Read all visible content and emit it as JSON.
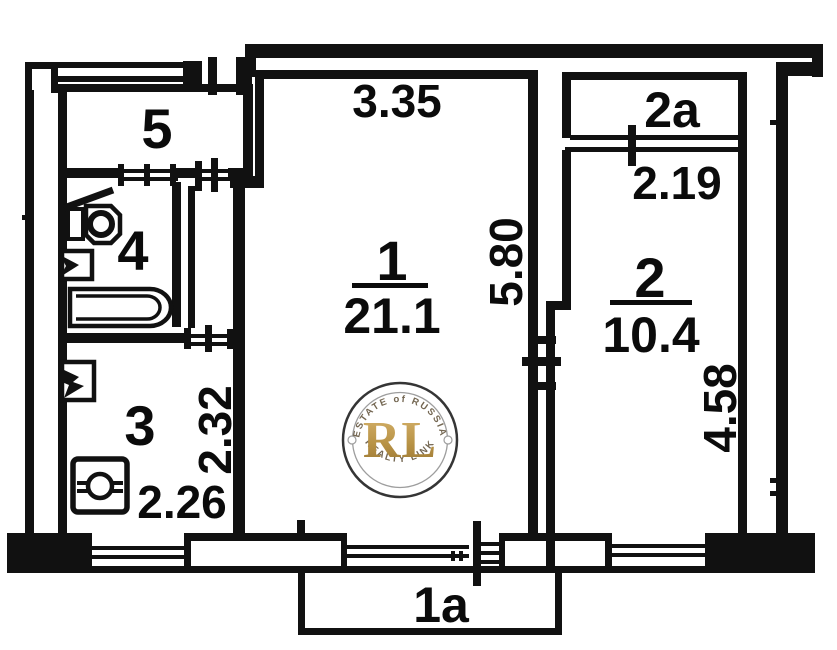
{
  "plan": {
    "title": "apartment-floor-plan",
    "rooms": [
      {
        "id": "room-1",
        "number": "1",
        "area": "21.1"
      },
      {
        "id": "room-2",
        "number": "2",
        "area": "10.4"
      },
      {
        "id": "room-3",
        "number": "3"
      },
      {
        "id": "room-4",
        "number": "4"
      },
      {
        "id": "room-5",
        "number": "5"
      },
      {
        "id": "balcony-2a",
        "number": "2a"
      },
      {
        "id": "balcony-1a",
        "number": "1a"
      }
    ],
    "dimensions": {
      "room1_width": "3.35",
      "room1_height": "5.80",
      "room2_width": "2.19",
      "room2_height": "4.58",
      "kitchen_height": "2.32",
      "kitchen_width": "2.26"
    },
    "colors": {
      "wall": "#111111",
      "background": "#ffffff"
    }
  },
  "watermark": {
    "arc_top": "ESTATE of RUSSIA",
    "initials": "RL",
    "arc_bottom": "REALTY LINK",
    "gold_light": "#cfa95f",
    "gold_dark": "#9c772e"
  }
}
